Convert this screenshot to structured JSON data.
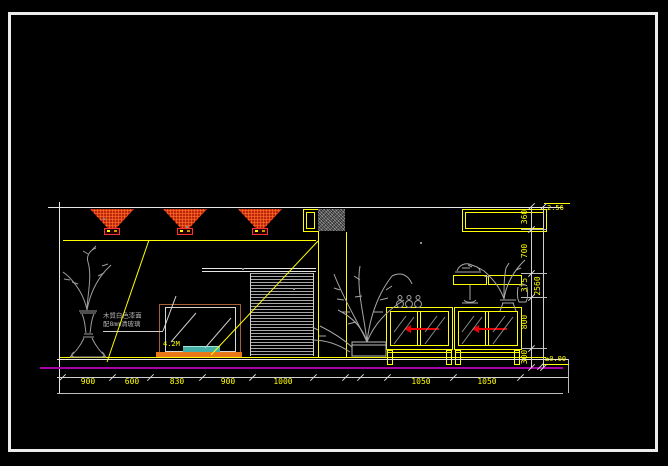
{
  "drawing": {
    "levels": {
      "top": "2.56",
      "floor": "±0.00"
    },
    "tv_label": "4.2M",
    "note": {
      "line1": "木質白色漆面",
      "line2": "配8mm清玻璃"
    },
    "dims_bottom": [
      "900",
      "600",
      "830",
      "900",
      "1000",
      "1050",
      "1050"
    ],
    "dims_right": [
      "360",
      "700",
      "375",
      "800",
      "300"
    ],
    "dim_total": "2560",
    "colors": {
      "line_accent": "#ffff00",
      "spotlight_red": "#cc0000",
      "floor_magenta": "#aa00aa",
      "glass_cyan": "#45b0a8",
      "base_orange": "#e87818"
    }
  }
}
